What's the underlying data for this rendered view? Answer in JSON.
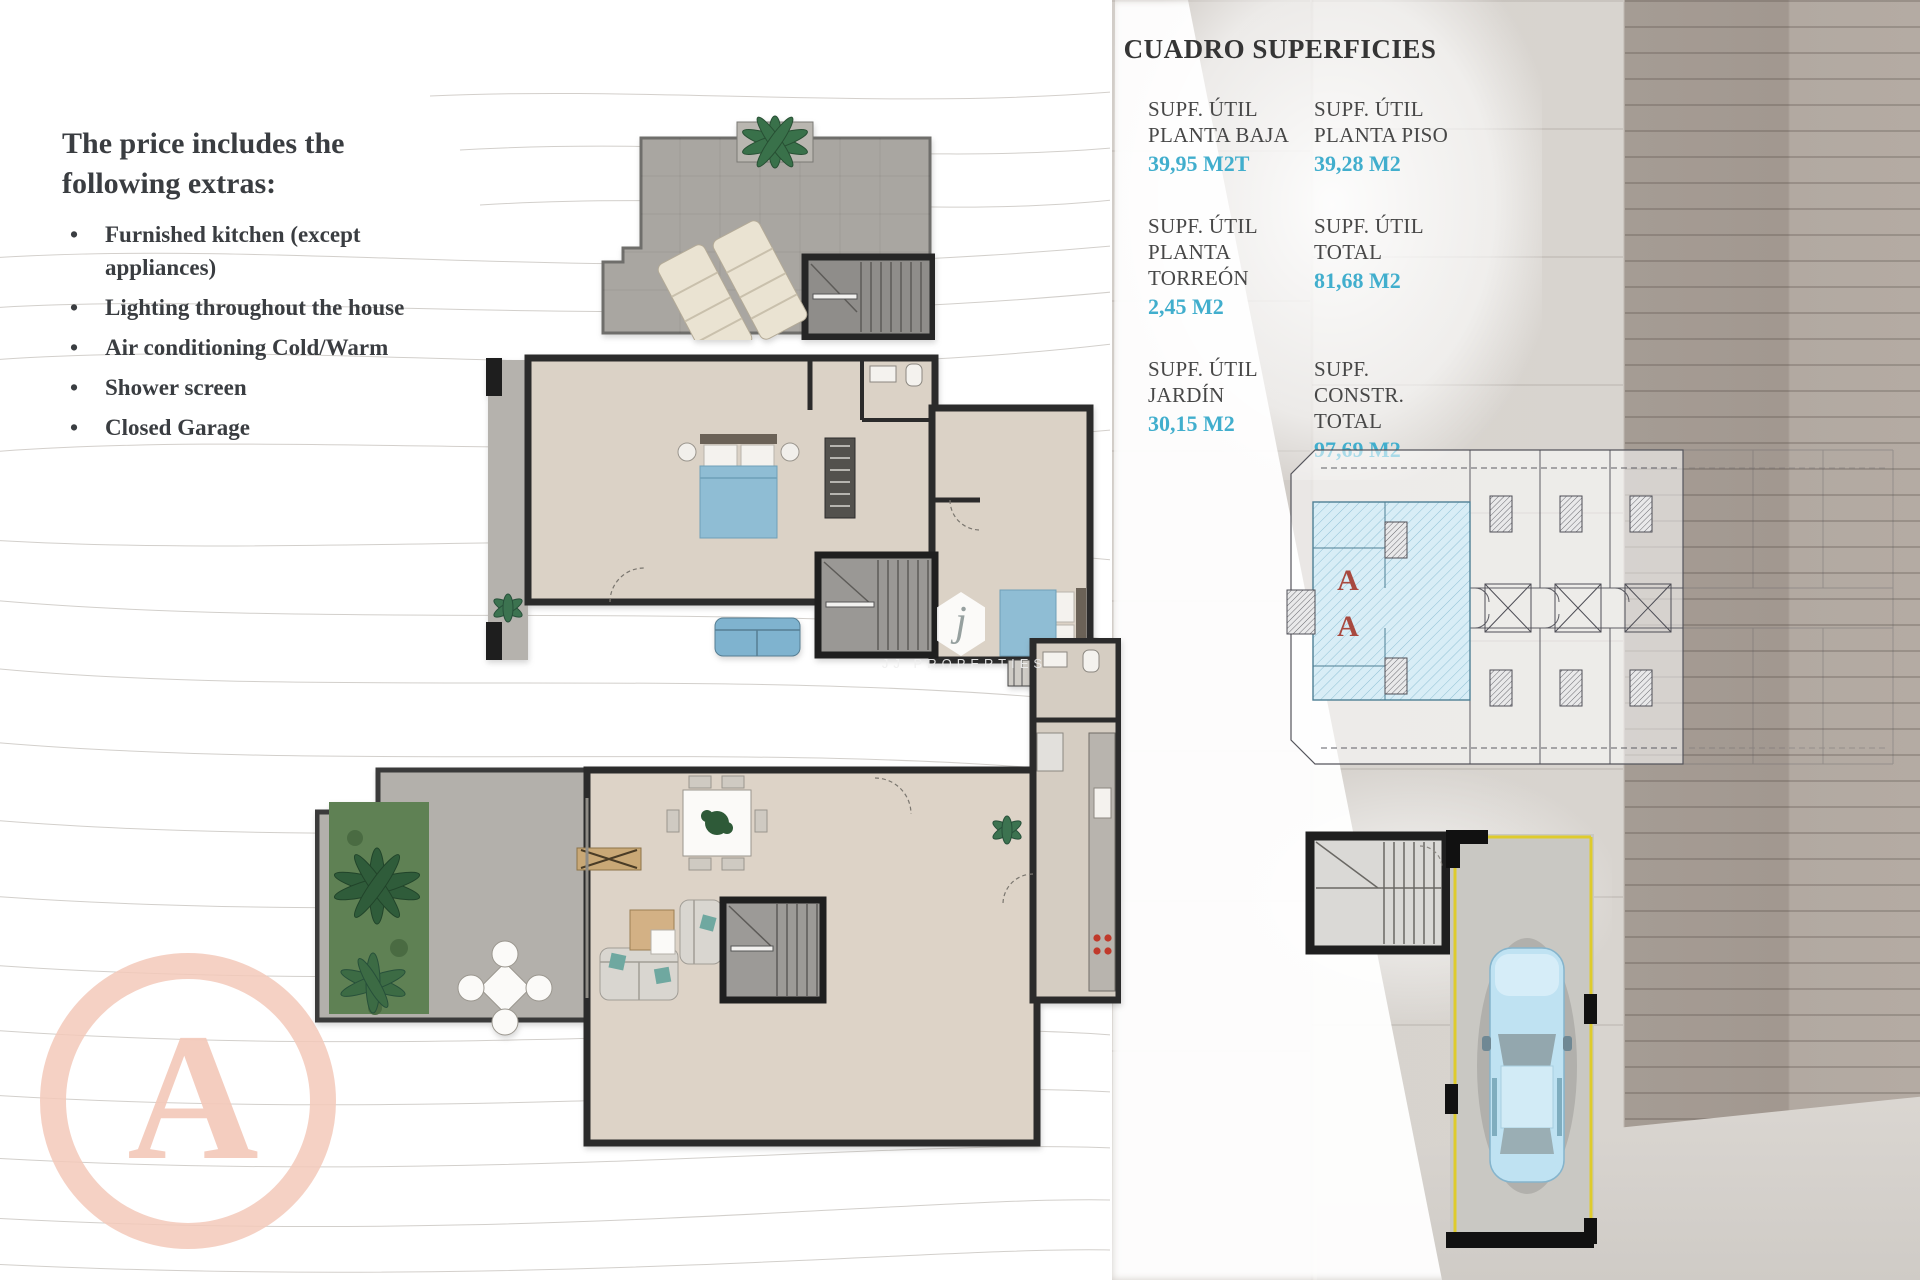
{
  "extras": {
    "heading": "The price includes the following extras:",
    "items": [
      "Furnished kitchen (except appliances)",
      "Lighting throughout the house",
      "Air conditioning Cold/Warm",
      "Shower screen",
      "Closed Garage"
    ]
  },
  "surfaces": {
    "title": "CUADRO SUPERFICIES",
    "entries": [
      {
        "label1": "SUPF. ÚTIL",
        "label2": "PLANTA BAJA",
        "value": "39,95 M2T"
      },
      {
        "label1": "SUPF. ÚTIL",
        "label2": "PLANTA PISO",
        "value": "39,28 M2"
      },
      {
        "label1": "SUPF. ÚTIL",
        "label2": "PLANTA TORREÓN",
        "value": "2,45 M2"
      },
      {
        "label1": "SUPF. ÚTIL",
        "label2": "TOTAL",
        "value": "81,68 M2"
      },
      {
        "label1": "SUPF. ÚTIL",
        "label2": "JARDÍN",
        "value": "30,15 M2"
      },
      {
        "label1": "SUPF. CONSTR.",
        "label2": "TOTAL",
        "value": "97,69 M2"
      }
    ]
  },
  "site_plan": {
    "markers": [
      "A",
      "A"
    ],
    "marker_color": "#a8493f",
    "highlight_color": "#d8edf6"
  },
  "garage_plan": {
    "outline_color": "#decb2d",
    "car_color": "#bfe2f2"
  },
  "watermark": {
    "letter": "A",
    "color": "#f3c9ba"
  },
  "logo": {
    "letter": "j",
    "text": "JJ PROPERTIES"
  },
  "colors": {
    "area_value": "#41aecd",
    "text_dark": "#3a3d41",
    "bed_blue": "#8fbdd4",
    "grass_green": "#5f8154",
    "stone_dark": "#a59c94"
  }
}
